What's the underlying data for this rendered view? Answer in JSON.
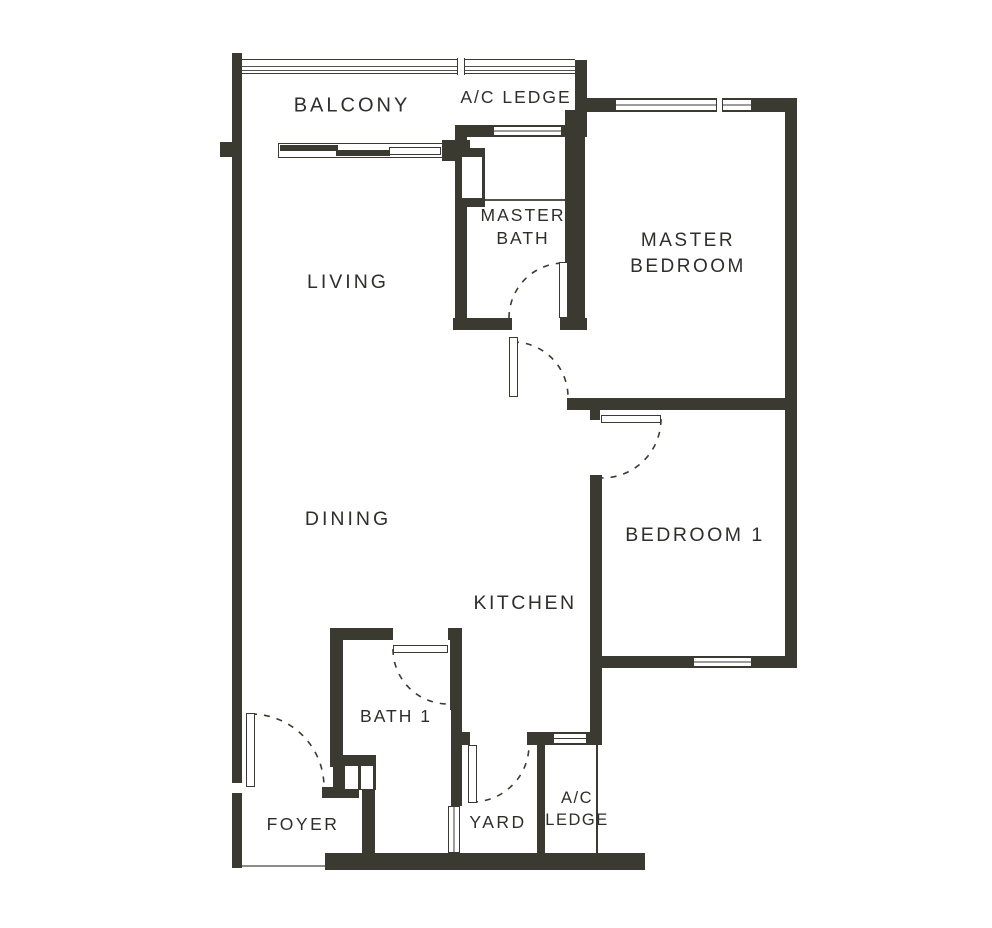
{
  "title": "2-bedroom apartment floor plan",
  "colors": {
    "wall": "#3a3a31",
    "thin": "#55544c",
    "text": "#2e2e2c",
    "bg": "#ffffff",
    "dash": "#3a3a31"
  },
  "room_labels": [
    {
      "id": "balcony",
      "lines": [
        "BALCONY"
      ],
      "x": 352,
      "y": 106,
      "fs": 20,
      "ls": 3
    },
    {
      "id": "ac-ledge-top",
      "lines": [
        "A/C LEDGE"
      ],
      "x": 516,
      "y": 97,
      "fs": 17.5,
      "ls": 2
    },
    {
      "id": "master-bath",
      "lines": [
        "MASTER",
        "BATH"
      ],
      "x": 523,
      "y": 227,
      "fs": 17.5,
      "ls": 2,
      "lh": 23
    },
    {
      "id": "master-bedroom",
      "lines": [
        "MASTER",
        "BEDROOM"
      ],
      "x": 688,
      "y": 254,
      "fs": 19,
      "ls": 2.5,
      "lh": 26
    },
    {
      "id": "living",
      "lines": [
        "LIVING"
      ],
      "x": 348,
      "y": 282,
      "fs": 19.5,
      "ls": 3
    },
    {
      "id": "dining",
      "lines": [
        "DINING"
      ],
      "x": 348,
      "y": 519,
      "fs": 19.5,
      "ls": 3
    },
    {
      "id": "kitchen",
      "lines": [
        "KITCHEN"
      ],
      "x": 525,
      "y": 603,
      "fs": 19.5,
      "ls": 2.5
    },
    {
      "id": "bedroom-1",
      "lines": [
        "BEDROOM 1"
      ],
      "x": 695,
      "y": 535,
      "fs": 19.5,
      "ls": 2.5
    },
    {
      "id": "bath-1",
      "lines": [
        "BATH 1"
      ],
      "x": 396,
      "y": 716,
      "fs": 17.5,
      "ls": 2
    },
    {
      "id": "foyer",
      "lines": [
        "FOYER"
      ],
      "x": 303,
      "y": 824,
      "fs": 17.5,
      "ls": 2.5
    },
    {
      "id": "yard",
      "lines": [
        "YARD"
      ],
      "x": 498,
      "y": 822,
      "fs": 17.5,
      "ls": 2.5
    },
    {
      "id": "ac-ledge-bottom",
      "lines": [
        "A/C",
        "LEDGE"
      ],
      "x": 577,
      "y": 809,
      "fs": 16.5,
      "ls": 1.5,
      "lh": 22
    }
  ],
  "walls": [
    {
      "id": "outer-left",
      "x": 232,
      "y": 53,
      "w": 10,
      "h": 815
    },
    {
      "id": "balcony-pier-left",
      "x": 220,
      "y": 142,
      "w": 22,
      "h": 15
    },
    {
      "id": "balcony-wall-right",
      "x": 442,
      "y": 140,
      "w": 28,
      "h": 21
    },
    {
      "id": "living-east",
      "x": 455,
      "y": 137,
      "w": 12,
      "h": 193
    },
    {
      "id": "shower-niche-block",
      "x": 455,
      "y": 148,
      "w": 30,
      "h": 59
    },
    {
      "id": "acledge-top-east",
      "x": 575,
      "y": 60,
      "w": 12,
      "h": 77
    },
    {
      "id": "acledge-top-south",
      "x": 455,
      "y": 125,
      "w": 132,
      "h": 12
    },
    {
      "id": "master-bedroom-north",
      "x": 585,
      "y": 98,
      "w": 212,
      "h": 14
    },
    {
      "id": "outer-right",
      "x": 785,
      "y": 98,
      "w": 12,
      "h": 570
    },
    {
      "id": "masterbath-east",
      "x": 565,
      "y": 110,
      "w": 20,
      "h": 220
    },
    {
      "id": "masterbath-south-west",
      "x": 453,
      "y": 318,
      "w": 59,
      "h": 12
    },
    {
      "id": "masterbath-south-east",
      "x": 560,
      "y": 318,
      "w": 27,
      "h": 12
    },
    {
      "id": "hall-south",
      "x": 567,
      "y": 398,
      "w": 218,
      "h": 12
    },
    {
      "id": "bedroom1-door-stub",
      "x": 590,
      "y": 408,
      "w": 10,
      "h": 12
    },
    {
      "id": "bedroom1-west",
      "x": 590,
      "y": 475,
      "w": 12,
      "h": 270
    },
    {
      "id": "bedroom1-south",
      "x": 600,
      "y": 656,
      "w": 197,
      "h": 12
    },
    {
      "id": "yard-north-west",
      "x": 452,
      "y": 732,
      "w": 18,
      "h": 13
    },
    {
      "id": "acledge-bottom-north",
      "x": 527,
      "y": 732,
      "w": 75,
      "h": 13
    },
    {
      "id": "yard-ledge-divider",
      "x": 537,
      "y": 745,
      "w": 8,
      "h": 108
    },
    {
      "id": "yard-west",
      "x": 451,
      "y": 707,
      "w": 11,
      "h": 99
    },
    {
      "id": "bath1-north",
      "x": 330,
      "y": 628,
      "w": 63,
      "h": 12
    },
    {
      "id": "bath1-ne-post",
      "x": 448,
      "y": 628,
      "w": 14,
      "h": 12
    },
    {
      "id": "bath1-east",
      "x": 450,
      "y": 640,
      "w": 12,
      "h": 70
    },
    {
      "id": "bath1-west",
      "x": 330,
      "y": 628,
      "w": 13,
      "h": 139
    },
    {
      "id": "laundry-block",
      "x": 333,
      "y": 755,
      "w": 43,
      "h": 35
    },
    {
      "id": "foyer-bar",
      "x": 322,
      "y": 787,
      "w": 37,
      "h": 11
    },
    {
      "id": "laundry-east",
      "x": 362,
      "y": 787,
      "w": 13,
      "h": 68
    },
    {
      "id": "outer-bottom",
      "x": 325,
      "y": 853,
      "w": 320,
      "h": 17
    }
  ],
  "windows": [
    {
      "id": "master-bedroom-window",
      "x": 615,
      "y": 99,
      "w": 137,
      "h": 12,
      "style": "framed",
      "orient": "h"
    },
    {
      "id": "master-bath-window",
      "x": 493,
      "y": 126,
      "w": 69,
      "h": 10,
      "style": "framed",
      "orient": "h"
    },
    {
      "id": "bedroom1-window",
      "x": 693,
      "y": 657,
      "w": 59,
      "h": 10,
      "style": "framed",
      "orient": "h"
    },
    {
      "id": "acledge-bottom-vent",
      "x": 553,
      "y": 733,
      "w": 34,
      "h": 11,
      "style": "framed",
      "orient": "h"
    },
    {
      "id": "yard-vent",
      "x": 448,
      "y": 806,
      "w": 12,
      "h": 47,
      "style": "framed",
      "orient": "v"
    },
    {
      "id": "shower-niche",
      "x": 462,
      "y": 157,
      "w": 20,
      "h": 41,
      "style": "plain"
    },
    {
      "id": "entry-notch",
      "x": 231,
      "y": 783,
      "w": 13,
      "h": 10,
      "style": "plain"
    },
    {
      "id": "laundry-niche-1",
      "x": 345,
      "y": 766,
      "w": 13,
      "h": 23,
      "style": "plain"
    },
    {
      "id": "laundry-niche-2",
      "x": 361,
      "y": 766,
      "w": 12,
      "h": 23,
      "style": "plain"
    }
  ],
  "posts": [
    {
      "id": "railing-divider",
      "x": 457,
      "y": 58,
      "w": 8,
      "h": 17
    },
    {
      "id": "mbr-window-divider",
      "x": 716,
      "y": 98,
      "w": 7,
      "h": 14
    }
  ],
  "lines": [
    {
      "id": "foyer-bottom-line",
      "x": 242,
      "y": 865,
      "w": 83,
      "h": 2,
      "color": "#8d8d88"
    },
    {
      "id": "shower-line",
      "x": 485,
      "y": 199,
      "w": 80,
      "h": 1.5,
      "color": "#55544c"
    },
    {
      "id": "acledge-bottom-edge",
      "x": 596,
      "y": 745,
      "w": 1.5,
      "h": 108,
      "color": "#3a3a31"
    }
  ],
  "railing": {
    "id": "balcony-railing",
    "x": 242,
    "y": 59,
    "w": 333,
    "h": 15,
    "line_offsets": [
      5.5,
      9.5
    ]
  },
  "sliding_door": {
    "track": {
      "x": 278,
      "y": 143,
      "w": 165,
      "h": 15
    },
    "bars": [
      {
        "x": 280,
        "y": 145,
        "w": 58,
        "h": 6
      },
      {
        "x": 336,
        "y": 150,
        "w": 54,
        "h": 6
      }
    ],
    "panel": {
      "x": 389,
      "y": 147,
      "w": 52,
      "h": 8
    }
  },
  "door_leaves": [
    {
      "id": "master-bath-door-leaf",
      "x": 559,
      "y": 262,
      "w": 9,
      "h": 56
    },
    {
      "id": "master-bedroom-door-leaf",
      "x": 509,
      "y": 337,
      "w": 9,
      "h": 60
    },
    {
      "id": "bedroom1-door-leaf",
      "x": 601,
      "y": 415,
      "w": 60,
      "h": 8
    },
    {
      "id": "bath1-door-leaf",
      "x": 393,
      "y": 645,
      "w": 55,
      "h": 8
    },
    {
      "id": "yard-door-leaf",
      "x": 468,
      "y": 745,
      "w": 9,
      "h": 58
    },
    {
      "id": "entry-door-leaf",
      "x": 246,
      "y": 713,
      "w": 9,
      "h": 74
    }
  ],
  "door_arcs": [
    {
      "id": "master-bath-door-arc",
      "d": "M 509 318 A 55 55 0 0 1 564 263"
    },
    {
      "id": "master-bedroom-door-arc",
      "d": "M 513 342 A 55 55 0 0 1 568 397"
    },
    {
      "id": "bedroom1-door-arc",
      "d": "M 661 419 A 59 59 0 0 1 601 478"
    },
    {
      "id": "bath1-door-arc",
      "d": "M 393 649 A 55 55 0 0 0 448 704"
    },
    {
      "id": "yard-door-arc",
      "d": "M 472 802 A 57 57 0 0 0 529 745"
    },
    {
      "id": "entry-door-arc",
      "d": "M 251 714 A 73 73 0 0 1 324 787"
    }
  ]
}
